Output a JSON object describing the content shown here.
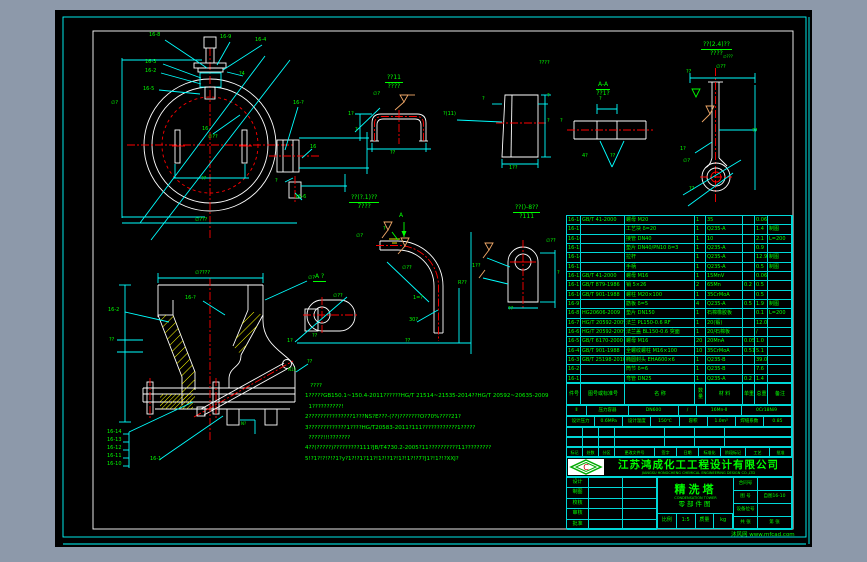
{
  "company": {
    "name": "江苏鸿成化工工程设计有限公司",
    "name_en": "JIANGSU HONGCHENG CHEMICAL ENGINEERING DESIGN CO.,LTD"
  },
  "titleblock": {
    "title": "精洗塔",
    "title_en": "CONDENSATION TOWER",
    "subtitle": "零部件图",
    "sig_rows": [
      {
        "l": "设计"
      },
      {
        "l": "制图"
      },
      {
        "l": "校核"
      },
      {
        "l": "审核"
      },
      {
        "l": "批准"
      }
    ],
    "bottom_cells": [
      "比例",
      "1:5",
      "质量",
      "kg"
    ],
    "right_rows": [
      {
        "l": "合同号",
        "v": ""
      },
      {
        "l": "图 号",
        "v": "自图16-10"
      },
      {
        "l": "设备位号",
        "v": ""
      },
      {
        "l": "共 张",
        "v": "第 张"
      }
    ]
  },
  "revision": {
    "headers": [
      "标记",
      "处数",
      "分区",
      "更改文件号",
      "签字",
      "日期",
      "标准化",
      "阶段标记",
      "工艺",
      "批准"
    ]
  },
  "summary": {
    "rowA": [
      "Ⅱ",
      "压力容器",
      "DN600",
      "/",
      "16Mn-Ⅱ",
      "0Cr18Ni9"
    ],
    "rowB": [
      "设计压力",
      "0.6MPa",
      "设计温度",
      "150℃",
      "容积",
      "1.0m³",
      "焊缝系数",
      "0.85"
    ]
  },
  "bom": {
    "header": {
      "no": "件号",
      "std": "图号或标准号",
      "name": "名  称",
      "qty": "数量",
      "mat": "材  料",
      "uw": "单重",
      "tw": "总重",
      "rem": "备注"
    },
    "rows": [
      {
        "no": "16-18",
        "std": "GB/T 41-2000",
        "name": "螺母 M20",
        "qty": "1",
        "mat": "35",
        "uw": "",
        "tw": "0.06",
        "rem": ""
      },
      {
        "no": "16-17",
        "std": "",
        "name": "工艺块 δ=20",
        "qty": "1",
        "mat": "Q235-A",
        "uw": "",
        "tw": "1.4",
        "rem": "制图"
      },
      {
        "no": "16-16",
        "std": "",
        "name": "接管 DN40",
        "qty": "1",
        "mat": "10",
        "uw": "",
        "tw": "2.1",
        "rem": "L=200"
      },
      {
        "no": "16-15",
        "std": "",
        "name": "垫片 DN40/PN10 δ=3",
        "qty": "1",
        "mat": "Q235-A",
        "uw": "",
        "tw": "0.9",
        "rem": ""
      },
      {
        "no": "16-14",
        "std": "",
        "name": "拉杆",
        "qty": "1",
        "mat": "Q235-A",
        "uw": "",
        "tw": "12.9",
        "rem": "制图"
      },
      {
        "no": "16-13",
        "std": "",
        "name": "手柄",
        "qty": "1",
        "mat": "Q235-A",
        "uw": "",
        "tw": "0.5",
        "rem": "制图"
      },
      {
        "no": "16-12",
        "std": "GB/T 41-2000",
        "name": "螺母 M16",
        "qty": "1",
        "mat": "15MnV",
        "uw": "",
        "tw": "0.06",
        "rem": ""
      },
      {
        "no": "16-11",
        "std": "GB/T 879-1986",
        "name": "销 5×26",
        "qty": "2",
        "mat": "65Mn",
        "uw": "0.2",
        "tw": "0.5",
        "rem": ""
      },
      {
        "no": "16-10",
        "std": "GB/T 901-1988",
        "name": "螺柱 M20×100",
        "qty": "1",
        "mat": "35CrMoA",
        "uw": "",
        "tw": "0.5",
        "rem": ""
      },
      {
        "no": "16-9",
        "std": "",
        "name": "筋板 δ=5",
        "qty": "4",
        "mat": "Q235-A",
        "uw": "0.5",
        "tw": "1.9",
        "rem": "制图"
      },
      {
        "no": "16-8",
        "std": "HG20606-2009",
        "name": "垫片 DN150",
        "qty": "1",
        "mat": "石棉橡胶板",
        "uw": "",
        "tw": "0.1",
        "rem": "L=200"
      },
      {
        "no": "16-7",
        "std": "HG/T 20592-2009",
        "name": "法兰 PL150-0.6 RF",
        "qty": "1",
        "mat": "20(锻)",
        "uw": "",
        "tw": "12.0",
        "rem": ""
      },
      {
        "no": "16-6",
        "std": "HG/T 20592-2009",
        "name": "法兰盖 BL150-0.6 突面",
        "qty": "1",
        "mat": "20/石棉板",
        "uw": "",
        "tw": "/",
        "rem": ""
      },
      {
        "no": "16-5",
        "std": "GB/T 6170-2000",
        "name": "螺母 M16",
        "qty": "20",
        "mat": "20MnA",
        "uw": "0.05",
        "tw": "1.0",
        "rem": ""
      },
      {
        "no": "16-4",
        "std": "GB/T 901-1988",
        "name": "全螺纹螺柱 M16×100",
        "qty": "10",
        "mat": "35CrMoA",
        "uw": "0.51",
        "tw": "5.1",
        "rem": ""
      },
      {
        "no": "16-3",
        "std": "GB/T 25198-2010",
        "name": "椭圆封头 EHA600×6",
        "qty": "1",
        "mat": "Q235-B",
        "uw": "",
        "tw": "39.0",
        "rem": ""
      },
      {
        "no": "16-2",
        "std": "",
        "name": "筒节 δ=6",
        "qty": "1",
        "mat": "Q235-B",
        "uw": "",
        "tw": "7.6",
        "rem": ""
      },
      {
        "no": "16-1",
        "std": "",
        "name": "弯管 DN25",
        "qty": "1",
        "mat": "Q235-A",
        "uw": "0.2",
        "tw": "1.4",
        "rem": ""
      }
    ]
  },
  "notes": {
    "lines": [
      "   ????",
      "1?????GB150.1~150.4-2011??????HG/T 21514~21535-2014??HG/T 20592~20635-2009",
      "  1??????????!",
      "2???????????????1???NS?E???-(??)???????O?70%????21?",
      "3?????????????1????HG/T20583-2011?111????????????1?????",
      "  ?????!!!???????",
      "4??(?????)?????????111?JB/T4730.2-2005?11??????????11?????????",
      "5!?1?!?!?!?1?y?1?!?1?11?!1?!?1?!1?!1?!?7?J1?!1?!?XXJ?"
    ]
  },
  "titles": [
    {
      "l1": "??11",
      "l2": "????",
      "x": 330,
      "y": 64
    },
    {
      "l1": "A-A",
      "l2": "??1?",
      "x": 541,
      "y": 71
    },
    {
      "l1": "??(2.4)??",
      "l2": "????",
      "x": 646,
      "y": 31
    },
    {
      "l1": "??(?.1)??",
      "l2": "7???",
      "x": 294,
      "y": 184
    },
    {
      "l1": "??()-8??",
      "l2": "?111",
      "x": 458,
      "y": 194
    },
    {
      "l1": "A ?",
      "l2": "",
      "x": 258,
      "y": 263
    }
  ],
  "annotations": [
    {
      "t": "16-8",
      "x": 94,
      "y": 22
    },
    {
      "t": "16-9",
      "x": 165,
      "y": 24
    },
    {
      "t": "16-4",
      "x": 200,
      "y": 27
    },
    {
      "t": "16-3",
      "x": 90,
      "y": 49
    },
    {
      "t": "16-2",
      "x": 90,
      "y": 58
    },
    {
      "t": "16-5",
      "x": 88,
      "y": 76
    },
    {
      "t": "∅?",
      "x": 56,
      "y": 90
    },
    {
      "t": "16",
      "x": 147,
      "y": 116
    },
    {
      "t": "∅??",
      "x": 153,
      "y": 124
    },
    {
      "t": "?4",
      "x": 184,
      "y": 61
    },
    {
      "t": "16-?",
      "x": 238,
      "y": 90
    },
    {
      "t": "16",
      "x": 255,
      "y": 134
    },
    {
      "t": "?",
      "x": 220,
      "y": 168
    },
    {
      "t": "16-6",
      "x": 240,
      "y": 184
    },
    {
      "t": "??",
      "x": 146,
      "y": 166
    },
    {
      "t": "∅???",
      "x": 140,
      "y": 207
    },
    {
      "t": "1?",
      "x": 293,
      "y": 101
    },
    {
      "t": "∅?",
      "x": 318,
      "y": 81
    },
    {
      "t": "??",
      "x": 335,
      "y": 140
    },
    {
      "t": "?",
      "x": 300,
      "y": 117
    },
    {
      "t": "?(11)",
      "x": 388,
      "y": 101
    },
    {
      "t": "?",
      "x": 427,
      "y": 86
    },
    {
      "t": "?",
      "x": 492,
      "y": 83
    },
    {
      "t": "?",
      "x": 492,
      "y": 108
    },
    {
      "t": "1??",
      "x": 454,
      "y": 155
    },
    {
      "t": "????",
      "x": 484,
      "y": 50
    },
    {
      "t": "?",
      "x": 544,
      "y": 86
    },
    {
      "t": "4?",
      "x": 527,
      "y": 143
    },
    {
      "t": "??",
      "x": 555,
      "y": 143
    },
    {
      "t": "?",
      "x": 505,
      "y": 108
    },
    {
      "t": "∅??",
      "x": 661,
      "y": 54
    },
    {
      "t": "??",
      "x": 631,
      "y": 59
    },
    {
      "t": "??",
      "x": 697,
      "y": 118
    },
    {
      "t": "1?",
      "x": 625,
      "y": 136
    },
    {
      "t": "∅?",
      "x": 628,
      "y": 148
    },
    {
      "t": "??",
      "x": 634,
      "y": 176
    },
    {
      "t": "∅???",
      "x": 668,
      "y": 44,
      "size": 4
    },
    {
      "t": "∅??",
      "x": 278,
      "y": 283
    },
    {
      "t": "1?",
      "x": 232,
      "y": 328
    },
    {
      "t": "??",
      "x": 257,
      "y": 323
    },
    {
      "t": "A",
      "x": 344,
      "y": 203,
      "size": 6
    },
    {
      "t": "?",
      "x": 328,
      "y": 216
    },
    {
      "t": "∅?",
      "x": 301,
      "y": 223
    },
    {
      "t": "∅??",
      "x": 347,
      "y": 255
    },
    {
      "t": "30?",
      "x": 354,
      "y": 307
    },
    {
      "t": "??",
      "x": 350,
      "y": 328
    },
    {
      "t": "R??",
      "x": 403,
      "y": 270
    },
    {
      "t": "1=?",
      "x": 358,
      "y": 285
    },
    {
      "t": "∅??",
      "x": 491,
      "y": 228
    },
    {
      "t": "1??",
      "x": 417,
      "y": 253
    },
    {
      "t": "??",
      "x": 453,
      "y": 296
    },
    {
      "t": "?",
      "x": 502,
      "y": 260
    },
    {
      "t": "16-2",
      "x": 53,
      "y": 297
    },
    {
      "t": "16-?",
      "x": 130,
      "y": 285
    },
    {
      "t": "∅?",
      "x": 253,
      "y": 265
    },
    {
      "t": "??",
      "x": 54,
      "y": 327
    },
    {
      "t": "??",
      "x": 252,
      "y": 349
    },
    {
      "t": "N15",
      "x": 233,
      "y": 357,
      "size": 4
    },
    {
      "t": "N?",
      "x": 186,
      "y": 411,
      "size": 4
    },
    {
      "t": "16-1",
      "x": 95,
      "y": 446
    },
    {
      "t": "16-14",
      "x": 52,
      "y": 419
    },
    {
      "t": "16-13",
      "x": 52,
      "y": 427
    },
    {
      "t": "16-12",
      "x": 52,
      "y": 435
    },
    {
      "t": "16-11",
      "x": 52,
      "y": 443
    },
    {
      "t": "16-10",
      "x": 52,
      "y": 451
    },
    {
      "t": "∅????",
      "x": 140,
      "y": 260
    }
  ],
  "watermark": "沐风网 www.mfcad.com"
}
